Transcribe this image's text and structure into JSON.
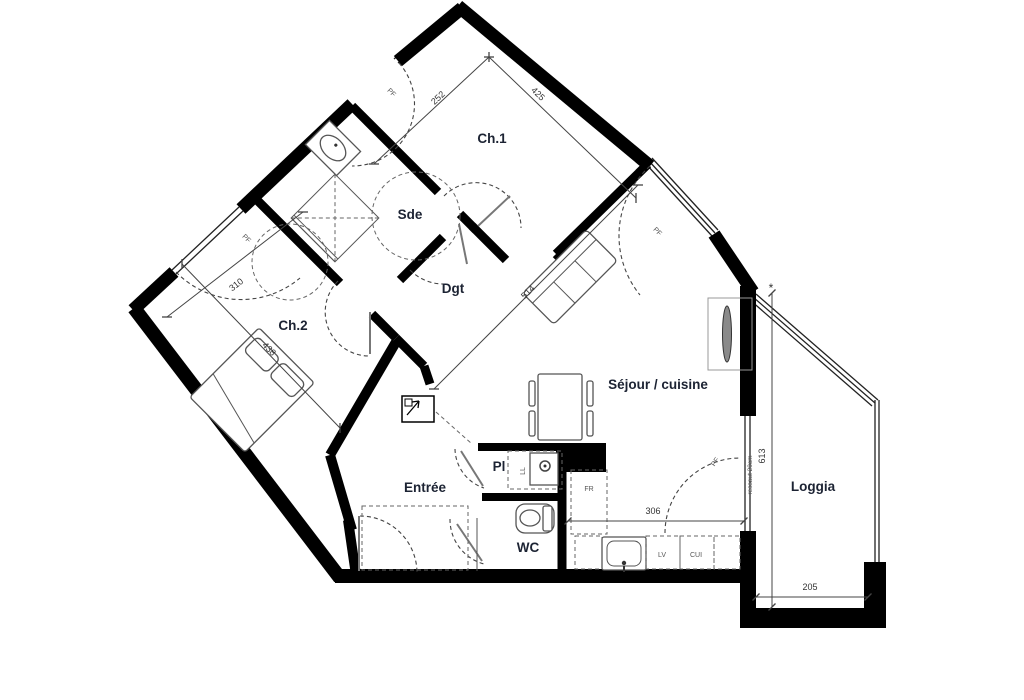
{
  "plan": {
    "background_color": "#ffffff",
    "wall_color": "#000000",
    "label_color": "#1c2333",
    "rooms": {
      "ch1": "Ch.1",
      "sde": "Sde",
      "dgt": "Dgt",
      "ch2": "Ch.2",
      "sejour": "Séjour / cuisine",
      "entree": "Entrée",
      "pl": "Pl",
      "wc": "WC",
      "loggia": "Loggia"
    },
    "dimensions": {
      "ch1_width": "252",
      "ch1_length": "425",
      "ch2_width": "310",
      "ch2_length": "438",
      "sejour_width": "514",
      "kitchen_width": "306",
      "loggia_depth": "613",
      "loggia_width": "205",
      "ressaut_note": "ressaut 20cm",
      "star_note": "*"
    },
    "tags": {
      "window": "PF",
      "washing_machine": "LL",
      "fridge": "FR",
      "dishwasher": "LV",
      "cooker": "CUI"
    }
  }
}
